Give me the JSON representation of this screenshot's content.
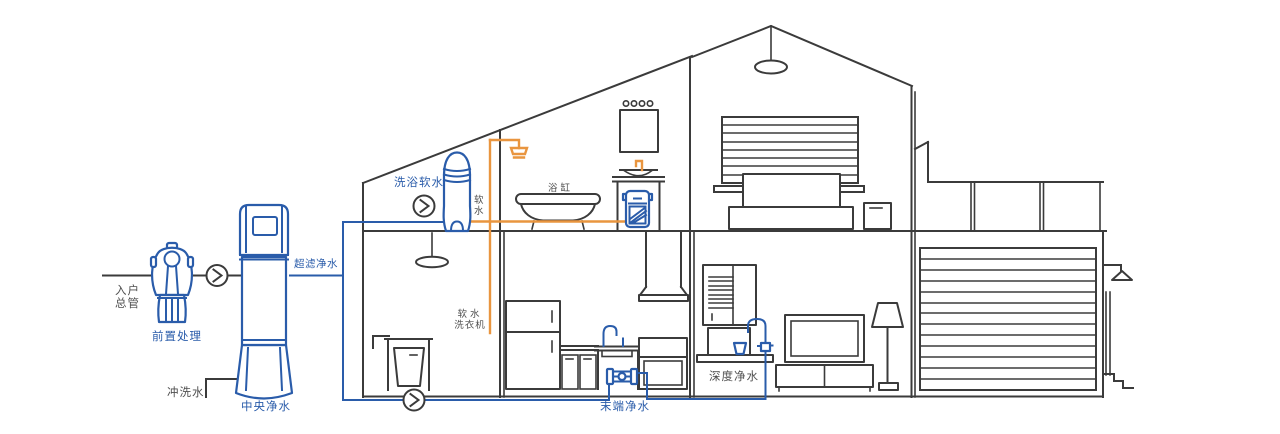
{
  "diagram": "whole-house water purification system in a house cross-section",
  "colors": {
    "bg": "#ffffff",
    "line": "#3b3b3b",
    "blue": "#2a5caa",
    "orange": "#e9953f",
    "label": "#4f4f4f"
  },
  "icons": {
    "flow-arrow": ">"
  },
  "labels": {
    "inlet_line1": "入户",
    "inlet_line2": "总管",
    "prefilter": "前置处理",
    "central": "中央净水",
    "flush": "冲洗水",
    "ultrafiltration": "超滤净水",
    "bath_softener": "洗浴软水",
    "soft_water": "软水",
    "bathtub": "浴缸",
    "washer_line1": "软水",
    "washer_line2": "洗衣机",
    "terminal": "末端净水",
    "deep": "深度净水"
  }
}
